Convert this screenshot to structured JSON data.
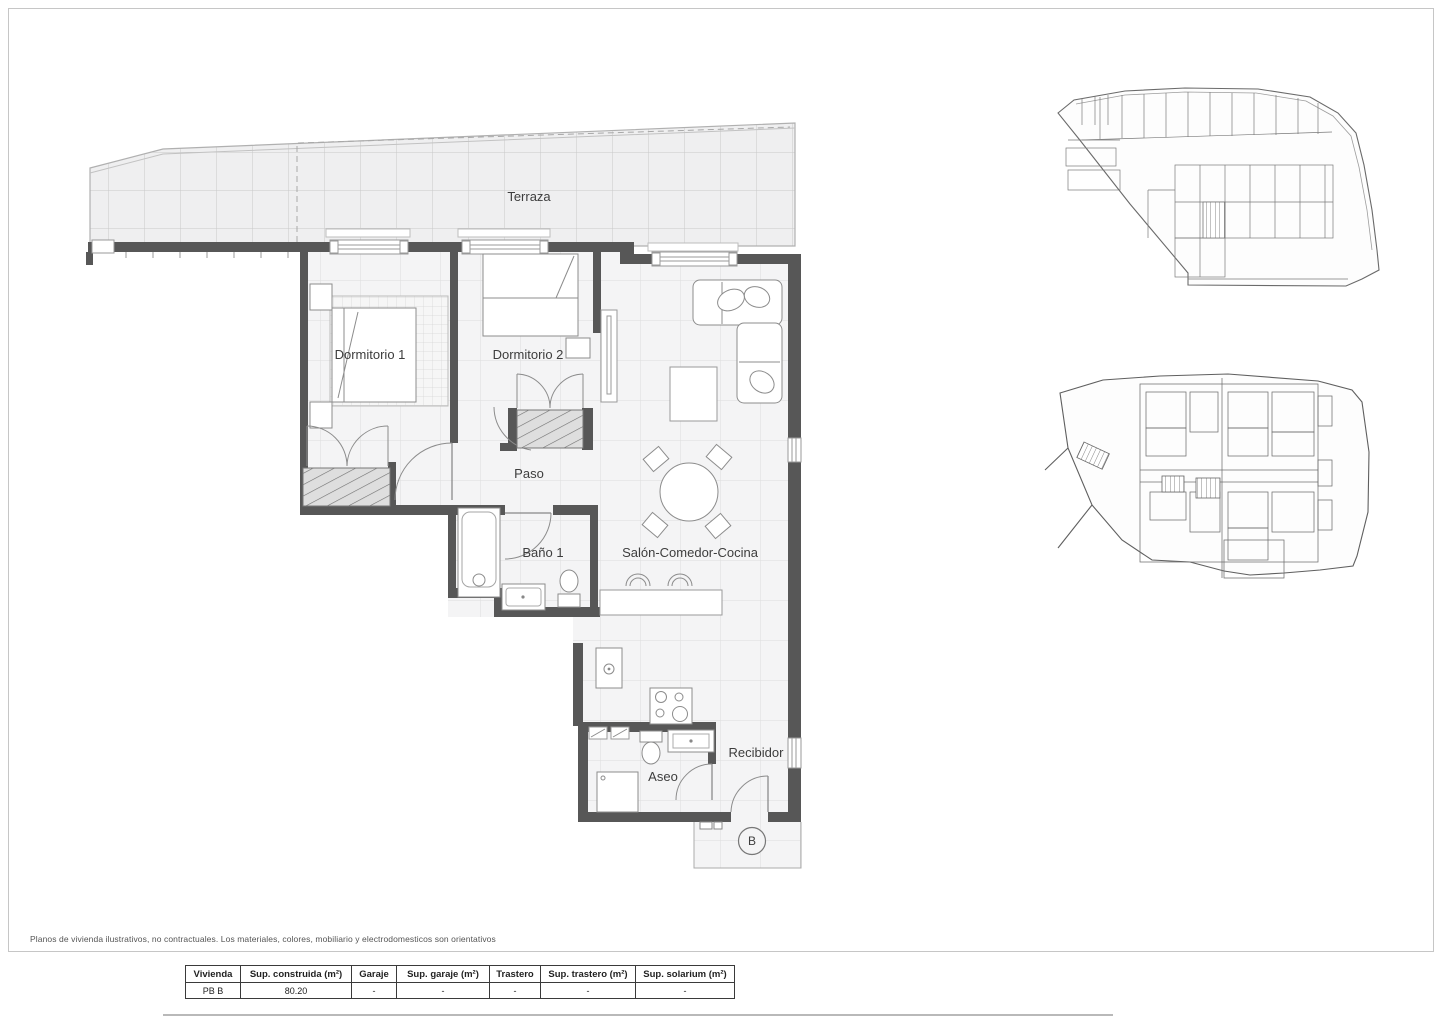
{
  "page": {
    "disclaimer": "Planos de vivienda ilustrativos, no contractuales. Los materiales, colores, mobiliario y electrodomesticos son orientativos",
    "unit_label": "B"
  },
  "floor_plan": {
    "rooms": [
      {
        "label": "Terraza"
      },
      {
        "label": "Dormitorio 1"
      },
      {
        "label": "Dormitorio 2"
      },
      {
        "label": "Paso"
      },
      {
        "label": "Baño 1"
      },
      {
        "label": "Salón-Comedor-Cocina"
      },
      {
        "label": "Aseo"
      },
      {
        "label": "Recibidor"
      }
    ]
  },
  "summary_table": {
    "headers": [
      "Vivienda",
      "Sup. construida (m²)",
      "Garaje",
      "Sup. garaje (m²)",
      "Trastero",
      "Sup. trastero (m²)",
      "Sup. solarium (m²)"
    ],
    "rows": [
      [
        "PB B",
        "80.20",
        "-",
        "-",
        "-",
        "-",
        "-"
      ]
    ]
  },
  "colors": {
    "wall": "#575757",
    "floor_tile": "#f2f2f3",
    "tile_line": "#cfcfcf",
    "furniture_line": "#8c8c8c",
    "text": "#3d3d3d"
  }
}
